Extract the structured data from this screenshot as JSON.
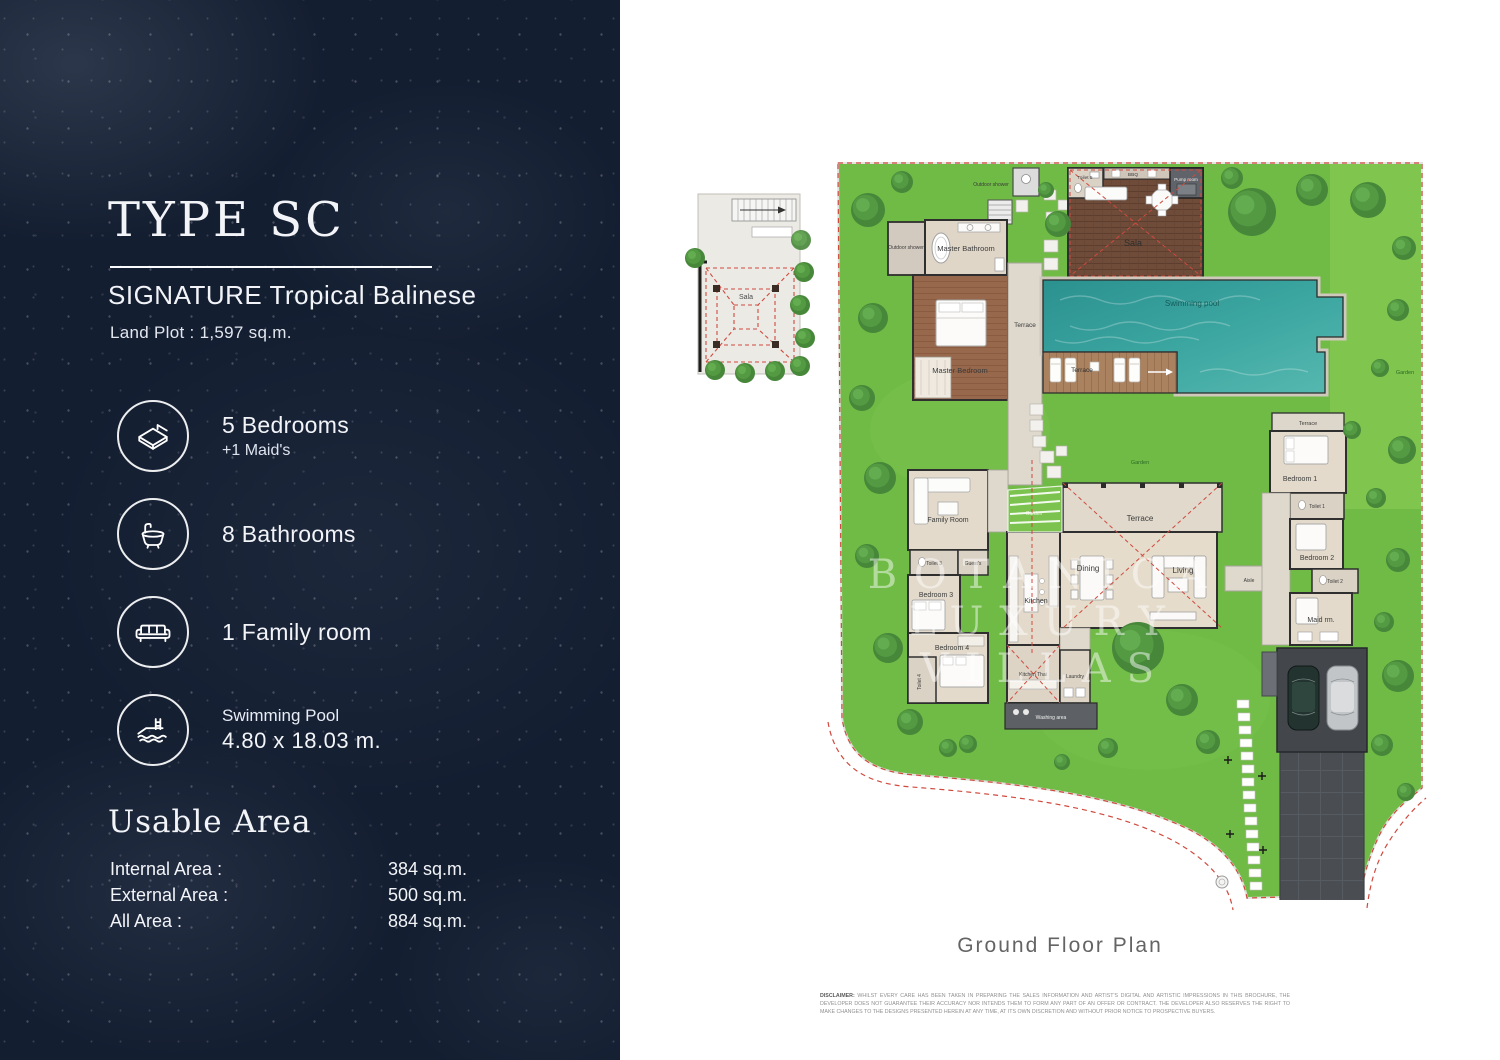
{
  "left_panel": {
    "type_title": "TYPE SC",
    "subtitle": "SIGNATURE Tropical Balinese",
    "land_plot": "Land Plot : 1,597 sq.m.",
    "features": [
      {
        "icon": "bed-icon",
        "line1": "5 Bedrooms",
        "line2": "+1 Maid's"
      },
      {
        "icon": "bathtub-icon",
        "line1": "8 Bathrooms",
        "line2": ""
      },
      {
        "icon": "sofa-icon",
        "line1": "1 Family room",
        "line2": ""
      },
      {
        "icon": "pool-icon",
        "line1": "Swimming Pool",
        "line2": "4.80 x 18.03 m."
      }
    ],
    "usable_area": {
      "heading": "Usable Area",
      "rows": [
        {
          "label": "Internal Area :",
          "value": "384 sq.m."
        },
        {
          "label": "External Area :",
          "value": "500 sq.m."
        },
        {
          "label": "All Area :",
          "value": "884 sq.m."
        }
      ]
    }
  },
  "plan": {
    "caption": "Ground Floor Plan",
    "watermark": {
      "line1": "BOTANICA",
      "line2": "LUXURY",
      "line3": "VILLAS"
    },
    "disclaimer_label": "DISCLAIMER:",
    "disclaimer_text": "WHILST EVERY CARE HAS BEEN TAKEN IN PREPARING THE SALES INFORMATION AND ARTIST'S DIGITAL AND ARTISTIC IMPRESSIONS IN THIS BROCHURE, THE DEVELOPER DOES NOT GUARANTEE THEIR ACCURACY NOR INTENDS THEM TO FORM ANY PART OF AN OFFER OR CONTRACT. THE DEVELOPER ALSO RESERVES THE RIGHT TO MAKE CHANGES TO THE DESIGNS PRESENTED HEREIN AT ANY TIME, AT ITS OWN DISCRETION AND WITHOUT PRIOR NOTICE TO PROSPECTIVE BUYERS.",
    "labels": {
      "outdoor_shower_left": "Outdoor shower",
      "master_bathroom": "Master Bathroom",
      "master_bedroom": "Master Bedroom",
      "terrace_master": "Terrace",
      "outdoor_shower_top": "Outdoor shower",
      "toilet_5": "Toilet 5",
      "bbq": "BBQ",
      "pump_room": "Pump room",
      "sala": "Sala",
      "swimming_pool": "Swimming pool",
      "terrace_pool": "Terrace",
      "garden_right": "Garden",
      "garden_center": "Garden",
      "garden_court": "Garden",
      "terrace_wing": "Terrace",
      "bedroom_1": "Bedroom 1",
      "toilet_1": "Toilet 1",
      "bedroom_2": "Bedroom 2",
      "toilet_2": "Toilet 2",
      "maid_room": "Maid rm.",
      "family_room": "Family Room",
      "toilet_3": "Toilet 3",
      "guests": "Guest's",
      "bedroom_3": "Bedroom 3",
      "bedroom_4": "Bedroom 4",
      "toilet_4": "Toilet 4",
      "kitchen": "Kitchen",
      "kitchen_thai": "Kitchen Thai",
      "laundry": "Laundry",
      "washing_area": "Washing area",
      "dining": "Dining",
      "living": "Living",
      "terrace_main": "Terrace",
      "aisle": "Aisle",
      "sala_upper": "Sala"
    }
  },
  "colors": {
    "panel_navy": "#141e31",
    "lawn_green": "#6fbb45",
    "pool_teal": "#3ba5a0",
    "deck_wood": "#6f4c3a",
    "boundary_red": "#cf4a3e"
  }
}
